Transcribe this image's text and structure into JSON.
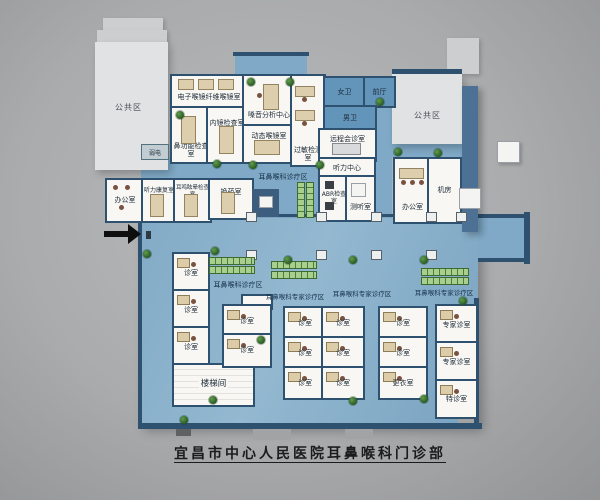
{
  "title": "宜昌市中心人民医院耳鼻喉科门诊部",
  "colors": {
    "corridor_blue": "#7fa9c6",
    "room_blue": "#6394ba",
    "wall_dark": "#2f5170",
    "accent_bar": "#4d7194",
    "public_gray": "#e1e2e4",
    "seat_green": "#a9cf8e",
    "plant_green": "#245220"
  },
  "areas": {
    "public_left": "公共区",
    "public_right": "公共区",
    "ent_clinic_upper": "耳鼻喉科诊疗区",
    "ent_clinic_lower": "耳鼻喉科诊疗区",
    "expert_area_1": "耳鼻喉科专家诊疗区",
    "expert_area_2": "耳鼻喉科专家诊疗区",
    "expert_area_3": "耳鼻喉科专家诊疗区"
  },
  "rooms": {
    "endoscope_suite": "电子喉镜纤维喉镜室",
    "nasal_function": "鼻功能检查室",
    "endoscopy_exam": "内镜检查室",
    "voice_analysis": "嗓音分析中心",
    "strobo_laryngoscope": "动态喉镜室",
    "allergy_test": "过敏检测室",
    "women_wc": "女卫",
    "front_hall": "前厅",
    "men_wc": "男卫",
    "remote_consult": "远程会诊室",
    "hearing_center": "听力中心",
    "abr_exam": "ABR检查室",
    "audiometry": "测听室",
    "office": "办公室",
    "machine_room": "机房",
    "hearing_rehab": "听力康复室",
    "tinnitus_vertigo_exam": "耳鸣眩晕检查室",
    "dressing_room": "换药室",
    "weak_current": "弱电",
    "stairwell": "楼梯间",
    "consult_room": "诊室",
    "changing_room": "更衣室",
    "expert_consult_room": "专家诊室",
    "special_consult_room": "特诊室"
  }
}
